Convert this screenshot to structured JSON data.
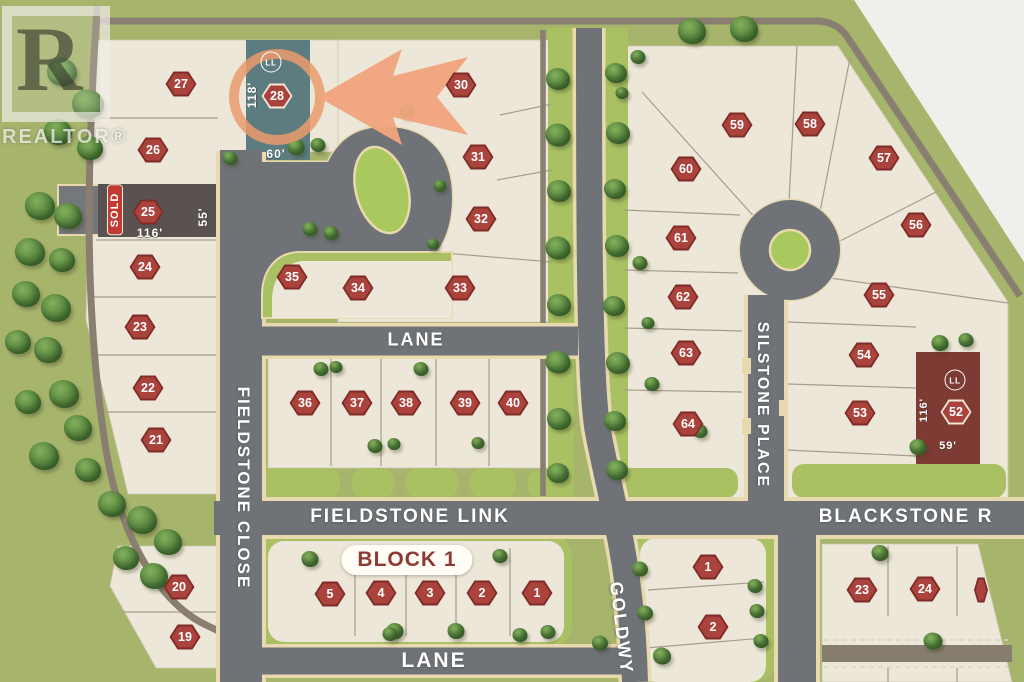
{
  "watermark": {
    "letter": "R",
    "label": "REALTOR®"
  },
  "streets": {
    "fieldstone_close": "FIELDSTONE CLOSE",
    "lane_upper": "LANE",
    "fieldstone_link": "FIELDSTONE LINK",
    "lane_lower": "LANE",
    "goldwyn": "GOLDWY",
    "silstone_place": "SILSTONE PLACE",
    "blackstone": "BLACKSTONE R"
  },
  "block_label": "BLOCK 1",
  "featured_lot": {
    "number": "28",
    "ll_label": "LL",
    "depth_label": "118'",
    "frontage_label": "60'"
  },
  "sold_lot": {
    "number": "25",
    "tag": "SOLD",
    "frontage_label": "116'",
    "depth_label": "55'"
  },
  "lot_52": {
    "number": "52",
    "ll_label": "LL",
    "depth_label": "116'",
    "frontage_label": "59'"
  },
  "colors": {
    "background_green": "#a6b46c",
    "lot_cream": "#ece7d8",
    "road_gray": "#6f7377",
    "road_edge_tan": "#e9d9ae",
    "boulevard_green": "#a9c163",
    "trail_brown": "#8a7e71",
    "badge_red": "#ab433d",
    "sold_fill": "#595250",
    "sold_tag_red": "#c23b32",
    "featured_teal": "#5d7c80",
    "lot52_maroon": "#7d3b33",
    "highlight_orange": "#f1a47d"
  },
  "lots": [
    {
      "n": "27",
      "x": 181,
      "y": 84
    },
    {
      "n": "28",
      "x": 277,
      "y": 96,
      "outline": true
    },
    {
      "n": "30",
      "x": 461,
      "y": 85
    },
    {
      "n": "26",
      "x": 153,
      "y": 150
    },
    {
      "n": "31",
      "x": 478,
      "y": 157
    },
    {
      "n": "25",
      "x": 148,
      "y": 212
    },
    {
      "n": "32",
      "x": 481,
      "y": 219
    },
    {
      "n": "24",
      "x": 145,
      "y": 267
    },
    {
      "n": "35",
      "x": 292,
      "y": 277
    },
    {
      "n": "34",
      "x": 358,
      "y": 288
    },
    {
      "n": "33",
      "x": 460,
      "y": 288
    },
    {
      "n": "23",
      "x": 140,
      "y": 327
    },
    {
      "n": "22",
      "x": 148,
      "y": 388
    },
    {
      "n": "36",
      "x": 305,
      "y": 403
    },
    {
      "n": "37",
      "x": 357,
      "y": 403
    },
    {
      "n": "38",
      "x": 406,
      "y": 403
    },
    {
      "n": "39",
      "x": 465,
      "y": 403
    },
    {
      "n": "40",
      "x": 513,
      "y": 403
    },
    {
      "n": "21",
      "x": 156,
      "y": 440
    },
    {
      "n": "20",
      "x": 179,
      "y": 587
    },
    {
      "n": "19",
      "x": 185,
      "y": 637
    },
    {
      "n": "5",
      "x": 330,
      "y": 594
    },
    {
      "n": "4",
      "x": 381,
      "y": 593
    },
    {
      "n": "3",
      "x": 430,
      "y": 593
    },
    {
      "n": "2",
      "x": 482,
      "y": 593
    },
    {
      "n": "1",
      "x": 537,
      "y": 593
    },
    {
      "n": "59",
      "x": 737,
      "y": 125
    },
    {
      "n": "58",
      "x": 810,
      "y": 124
    },
    {
      "n": "60",
      "x": 686,
      "y": 169
    },
    {
      "n": "57",
      "x": 884,
      "y": 158
    },
    {
      "n": "61",
      "x": 681,
      "y": 238
    },
    {
      "n": "56",
      "x": 916,
      "y": 225
    },
    {
      "n": "62",
      "x": 683,
      "y": 297
    },
    {
      "n": "55",
      "x": 879,
      "y": 295
    },
    {
      "n": "63",
      "x": 686,
      "y": 353
    },
    {
      "n": "54",
      "x": 864,
      "y": 355
    },
    {
      "n": "64",
      "x": 688,
      "y": 424
    },
    {
      "n": "53",
      "x": 860,
      "y": 413
    },
    {
      "n": "52",
      "x": 956,
      "y": 412,
      "outline": true
    },
    {
      "n": "1",
      "x": 708,
      "y": 567
    },
    {
      "n": "2",
      "x": 713,
      "y": 627
    },
    {
      "n": "23",
      "x": 862,
      "y": 590
    },
    {
      "n": "24",
      "x": 925,
      "y": 589
    },
    {
      "n": "",
      "x": 981,
      "y": 590,
      "partial": true
    }
  ],
  "trees": [
    [
      62,
      72,
      30
    ],
    [
      88,
      104,
      32
    ],
    [
      58,
      132,
      28
    ],
    [
      90,
      148,
      26
    ],
    [
      40,
      206,
      30
    ],
    [
      68,
      216,
      28
    ],
    [
      30,
      252,
      30
    ],
    [
      62,
      260,
      26
    ],
    [
      26,
      294,
      28
    ],
    [
      56,
      308,
      30
    ],
    [
      18,
      342,
      26
    ],
    [
      48,
      350,
      28
    ],
    [
      64,
      394,
      30
    ],
    [
      28,
      402,
      26
    ],
    [
      78,
      428,
      28
    ],
    [
      44,
      456,
      30
    ],
    [
      88,
      470,
      26
    ],
    [
      112,
      504,
      28
    ],
    [
      142,
      520,
      30
    ],
    [
      168,
      542,
      28
    ],
    [
      126,
      558,
      26
    ],
    [
      154,
      576,
      28
    ],
    [
      296,
      147,
      17
    ],
    [
      318,
      145,
      15
    ],
    [
      230,
      158,
      15
    ],
    [
      407,
      111,
      15
    ],
    [
      310,
      229,
      15
    ],
    [
      331,
      233,
      15
    ],
    [
      440,
      186,
      13
    ],
    [
      433,
      244,
      12
    ],
    [
      321,
      369,
      15
    ],
    [
      336,
      367,
      13
    ],
    [
      421,
      369,
      15
    ],
    [
      375,
      446,
      15
    ],
    [
      394,
      444,
      13
    ],
    [
      478,
      443,
      13
    ],
    [
      558,
      79,
      24
    ],
    [
      558,
      135,
      25
    ],
    [
      559,
      191,
      24
    ],
    [
      558,
      248,
      25
    ],
    [
      559,
      305,
      24
    ],
    [
      558,
      362,
      25
    ],
    [
      559,
      419,
      24
    ],
    [
      558,
      473,
      22
    ],
    [
      616,
      73,
      22
    ],
    [
      618,
      133,
      24
    ],
    [
      615,
      189,
      22
    ],
    [
      617,
      246,
      24
    ],
    [
      614,
      306,
      22
    ],
    [
      618,
      363,
      24
    ],
    [
      615,
      421,
      22
    ],
    [
      617,
      470,
      22
    ],
    [
      692,
      31,
      28
    ],
    [
      744,
      29,
      28
    ],
    [
      638,
      57,
      15
    ],
    [
      622,
      93,
      13
    ],
    [
      640,
      263,
      15
    ],
    [
      648,
      323,
      13
    ],
    [
      652,
      384,
      15
    ],
    [
      700,
      431,
      15
    ],
    [
      940,
      343,
      17
    ],
    [
      966,
      340,
      15
    ],
    [
      918,
      447,
      17
    ],
    [
      640,
      569,
      16
    ],
    [
      645,
      613,
      16
    ],
    [
      662,
      656,
      18
    ],
    [
      755,
      586,
      15
    ],
    [
      757,
      611,
      15
    ],
    [
      761,
      641,
      15
    ],
    [
      880,
      553,
      17
    ],
    [
      933,
      641,
      19
    ],
    [
      310,
      559,
      17
    ],
    [
      500,
      556,
      15
    ],
    [
      395,
      631,
      17
    ],
    [
      456,
      631,
      17
    ],
    [
      548,
      632,
      15
    ],
    [
      390,
      634,
      15
    ],
    [
      520,
      635,
      15
    ],
    [
      600,
      643,
      16
    ]
  ]
}
